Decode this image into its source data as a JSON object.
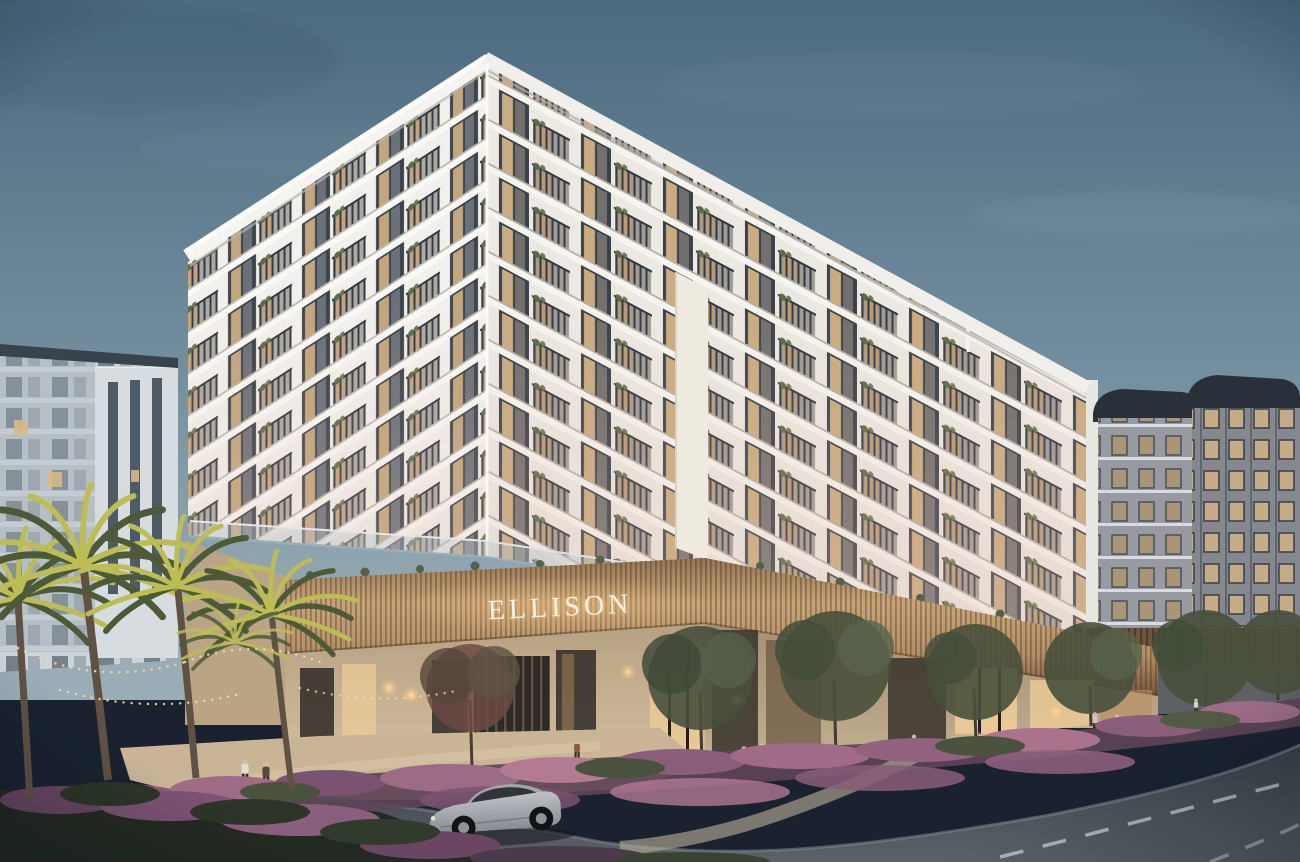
{
  "sign": {
    "text": "ELLISON"
  },
  "scene": {
    "subject": "mid-rise residential building with lit retail podium at dusk",
    "sign_text": "ELLISON",
    "main_building": {
      "floors_visible": 11,
      "balcony_bays_left_face": 4,
      "balcony_bays_right_face": 7,
      "features": [
        "stacked white balconies",
        "dark window frames",
        "warm interior lighting",
        "balcony plants",
        "white cornice parapet",
        "bronze slatted sign fascia"
      ]
    },
    "adjacent_buildings": [
      "white apartment block on left",
      "gray towers with dark curved roof caps on right"
    ],
    "vehicles": [
      {
        "type": "sedan",
        "color": "silver",
        "position": "foreground road, heading left"
      }
    ],
    "people_count_approx": 12,
    "palm_trees_count": 4,
    "street_trees_count": 7,
    "landscape": [
      "purple flowering groundcover",
      "dark foreground shrubs",
      "uplit palm trees",
      "winding light footpath"
    ],
    "lighting": [
      "warm window glow",
      "backlit slat fascia",
      "string lights",
      "wall sconces",
      "landscape uplights"
    ],
    "road": {
      "lane_markings": "white dashes",
      "shape": "sweeping curve to lower right"
    }
  },
  "palette": {
    "sky_top": "#4c6a80",
    "sky_mid": "#7590a0",
    "sky_horizon": "#9aadb6",
    "facade_white": "#f2f0ec",
    "facade_warm": "#ece8e2",
    "parapet": "#f5f4f1",
    "window_frame": "#3d434b",
    "window_glow": "#d9b887",
    "bronze_light": "#c7a478",
    "bronze_dark": "#6f5238",
    "sign_text_color": "#f8f0e2",
    "storefront_wall": "#cdb99a",
    "storefront_glass": "#37322c",
    "glass_lit": "#eac997",
    "palm_lit": "#bcbd55",
    "palm_dark": "#4d5a38",
    "trunk": "#5f5244",
    "tree_foliage": "#49503c",
    "flowers_purple": "#9c6b85",
    "flowers_pink": "#b27b93",
    "shrub_dark": "#232a21",
    "plaza": "#c9b596",
    "road": "#40474e",
    "lane_marking": "#ccd1d4",
    "car_body": "#9aa0a6",
    "bg_left": "#ccd4d9",
    "bg_right": "#85898f",
    "roof_cap": "#2a3039",
    "fence_bronze": "#6e563e"
  }
}
